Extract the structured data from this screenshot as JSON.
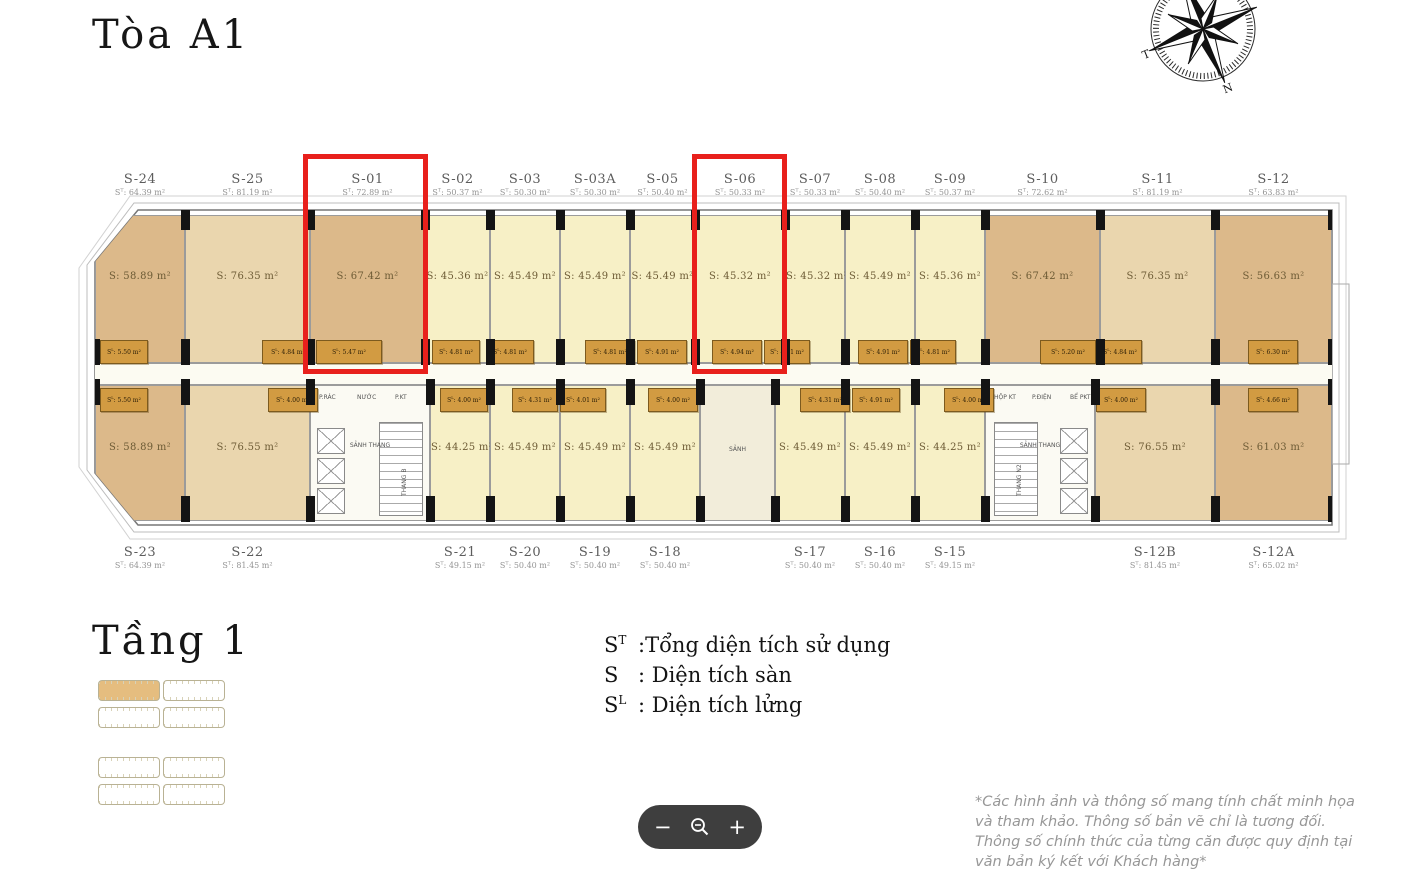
{
  "page": {
    "building_title": "Tòa A1",
    "floor_title": "Tầng 1"
  },
  "legend": {
    "items": [
      {
        "sym": "S",
        "sup": "T",
        "desc": ":Tổng diện tích sử dụng"
      },
      {
        "sym": "S",
        "sup": "",
        "desc": ": Diện tích sàn"
      },
      {
        "sym": "S",
        "sup": "L",
        "desc": ": Diện tích lửng"
      }
    ]
  },
  "disclaimer": "*Các hình ảnh và thông số mang tính chất minh họa và tham khảo. Thông số bản vẽ chỉ là tương đối. Thông số chính thức của từng căn được quy định tại văn bản ký kết với Khách hàng*",
  "zoom_controls": {
    "minus": "−",
    "plus": "+",
    "magnifier": "zoom-out-magnifier"
  },
  "compass": {
    "west_letter": "T",
    "south_letter": "N"
  },
  "labels": {
    "area_prefix": "S",
    "total_sup": "T",
    "mezz_sup": "L",
    "sep": ": ",
    "unit_suffix": "m²"
  },
  "colors": {
    "tan": "#dcb98a",
    "light_tan": "#ead6ae",
    "pale": "#f7f0c6",
    "lobby": "#f2edda",
    "core": "#fbfaf3",
    "mezz": "#d29b42",
    "highlight": "#e8201c",
    "wall": "#777777"
  },
  "plan": {
    "top_units": [
      {
        "type": "unit",
        "id": "S-24",
        "total": "64.39",
        "area": "58.89",
        "color": "tan",
        "x": 95,
        "w": 90
      },
      {
        "type": "unit",
        "id": "S-25",
        "total": "81.19",
        "area": "76.35",
        "color": "light_tan",
        "x": 185,
        "w": 125
      },
      {
        "type": "unit",
        "id": "S-01",
        "total": "72.89",
        "area": "67.42",
        "color": "tan",
        "x": 310,
        "w": 115,
        "highlighted": true
      },
      {
        "type": "unit",
        "id": "S-02",
        "total": "50.37",
        "area": "45.36",
        "color": "pale",
        "x": 425,
        "w": 65
      },
      {
        "type": "unit",
        "id": "S-03",
        "total": "50.30",
        "area": "45.49",
        "color": "pale",
        "x": 490,
        "w": 70
      },
      {
        "type": "unit",
        "id": "S-03A",
        "total": "50.30",
        "area": "45.49",
        "color": "pale",
        "x": 560,
        "w": 70
      },
      {
        "type": "unit",
        "id": "S-05",
        "total": "50.40",
        "area": "45.49",
        "color": "pale",
        "x": 630,
        "w": 65
      },
      {
        "type": "unit",
        "id": "S-06",
        "total": "50.33",
        "area": "45.32",
        "color": "pale",
        "x": 695,
        "w": 90,
        "highlighted": true
      },
      {
        "type": "unit",
        "id": "S-07",
        "total": "50.33",
        "area": "45.32",
        "color": "pale",
        "x": 785,
        "w": 60
      },
      {
        "type": "unit",
        "id": "S-08",
        "total": "50.40",
        "area": "45.49",
        "color": "pale",
        "x": 845,
        "w": 70
      },
      {
        "type": "unit",
        "id": "S-09",
        "total": "50.37",
        "area": "45.36",
        "color": "pale",
        "x": 915,
        "w": 70
      },
      {
        "type": "unit",
        "id": "S-10",
        "total": "72.62",
        "area": "67.42",
        "color": "tan",
        "x": 985,
        "w": 115
      },
      {
        "type": "unit",
        "id": "S-11",
        "total": "81.19",
        "area": "76.35",
        "color": "light_tan",
        "x": 1100,
        "w": 115
      },
      {
        "type": "unit",
        "id": "S-12",
        "total": "63.83",
        "area": "56.63",
        "color": "tan",
        "x": 1215,
        "w": 117
      }
    ],
    "bottom_units": [
      {
        "type": "unit",
        "id": "S-23",
        "total": "64.39",
        "area": "58.89",
        "color": "tan",
        "x": 95,
        "w": 90
      },
      {
        "type": "unit",
        "id": "S-22",
        "total": "81.45",
        "area": "76.55",
        "color": "light_tan",
        "x": 185,
        "w": 125
      },
      {
        "type": "core",
        "core": 0,
        "x": 310,
        "w": 120
      },
      {
        "type": "unit",
        "id": "S-21",
        "total": "49.15",
        "area": "44.25",
        "color": "pale",
        "x": 430,
        "w": 60
      },
      {
        "type": "unit",
        "id": "S-20",
        "total": "50.40",
        "area": "45.49",
        "color": "pale",
        "x": 490,
        "w": 70
      },
      {
        "type": "unit",
        "id": "S-19",
        "total": "50.40",
        "area": "45.49",
        "color": "pale",
        "x": 560,
        "w": 70
      },
      {
        "type": "unit",
        "id": "S-18",
        "total": "50.40",
        "area": "45.49",
        "color": "pale",
        "x": 630,
        "w": 70
      },
      {
        "type": "lobby",
        "label": "SẢNH",
        "x": 700,
        "w": 75
      },
      {
        "type": "unit",
        "id": "S-17",
        "total": "50.40",
        "area": "45.49",
        "color": "pale",
        "x": 775,
        "w": 70
      },
      {
        "type": "unit",
        "id": "S-16",
        "total": "50.40",
        "area": "45.49",
        "color": "pale",
        "x": 845,
        "w": 70
      },
      {
        "type": "unit",
        "id": "S-15",
        "total": "49.15",
        "area": "44.25",
        "color": "pale",
        "x": 915,
        "w": 70
      },
      {
        "type": "core",
        "core": 1,
        "x": 985,
        "w": 110
      },
      {
        "type": "unit",
        "id": "S-12B",
        "total": "81.45",
        "area": "76.55",
        "color": "light_tan",
        "x": 1095,
        "w": 120
      },
      {
        "type": "unit",
        "id": "S-12A",
        "total": "65.02",
        "area": "61.03",
        "color": "tan",
        "x": 1215,
        "w": 117
      }
    ],
    "cores": [
      {
        "hall": "SẢNH THANG",
        "stair": "THANG B",
        "rooms": [
          "P.RÁC",
          "NƯỚC",
          "P.KT"
        ]
      },
      {
        "hall": "SẢNH THANG",
        "stair": "THANG N2",
        "rooms": [
          "HỘP KT",
          "P.ĐIỆN",
          "BỂ PKT"
        ]
      }
    ],
    "mezz_top": [
      {
        "x": 100,
        "w": 48,
        "val": "5.50"
      },
      {
        "x": 262,
        "w": 52,
        "val": "4.84"
      },
      {
        "x": 316,
        "w": 66,
        "val": "5.47"
      },
      {
        "x": 432,
        "w": 48,
        "val": "4.81"
      },
      {
        "x": 486,
        "w": 48,
        "val": "4.81"
      },
      {
        "x": 585,
        "w": 50,
        "val": "4.81"
      },
      {
        "x": 637,
        "w": 50,
        "val": "4.91"
      },
      {
        "x": 712,
        "w": 50,
        "val": "4.94"
      },
      {
        "x": 764,
        "w": 46,
        "val": "4.81"
      },
      {
        "x": 858,
        "w": 50,
        "val": "4.91"
      },
      {
        "x": 910,
        "w": 46,
        "val": "4.81"
      },
      {
        "x": 1040,
        "w": 56,
        "val": "5.20"
      },
      {
        "x": 1098,
        "w": 44,
        "val": "4.84"
      },
      {
        "x": 1248,
        "w": 50,
        "val": "6.30"
      }
    ],
    "mezz_bottom": [
      {
        "x": 100,
        "w": 48,
        "val": "5.50"
      },
      {
        "x": 268,
        "w": 50,
        "val": "4.00"
      },
      {
        "x": 440,
        "w": 48,
        "val": "4.00"
      },
      {
        "x": 512,
        "w": 46,
        "val": "4.31"
      },
      {
        "x": 560,
        "w": 46,
        "val": "4.01"
      },
      {
        "x": 648,
        "w": 50,
        "val": "4.00"
      },
      {
        "x": 800,
        "w": 50,
        "val": "4.31"
      },
      {
        "x": 852,
        "w": 48,
        "val": "4.91"
      },
      {
        "x": 944,
        "w": 50,
        "val": "4.00"
      },
      {
        "x": 1096,
        "w": 50,
        "val": "4.00"
      },
      {
        "x": 1248,
        "w": 50,
        "val": "4.66"
      }
    ],
    "highlights": [
      {
        "unit": "S-01",
        "x": 303,
        "y": 154,
        "w": 125,
        "h": 220
      },
      {
        "unit": "S-06",
        "x": 692,
        "y": 154,
        "w": 95,
        "h": 220
      }
    ]
  },
  "site_map": {
    "bars": [
      {
        "x": 98,
        "y": 680,
        "highlighted": true
      },
      {
        "x": 163,
        "y": 680,
        "highlighted": false
      },
      {
        "x": 98,
        "y": 707,
        "highlighted": false
      },
      {
        "x": 163,
        "y": 707,
        "highlighted": false
      },
      {
        "x": 98,
        "y": 757,
        "highlighted": false
      },
      {
        "x": 163,
        "y": 757,
        "highlighted": false
      },
      {
        "x": 98,
        "y": 784,
        "highlighted": false
      },
      {
        "x": 163,
        "y": 784,
        "highlighted": false
      }
    ]
  }
}
